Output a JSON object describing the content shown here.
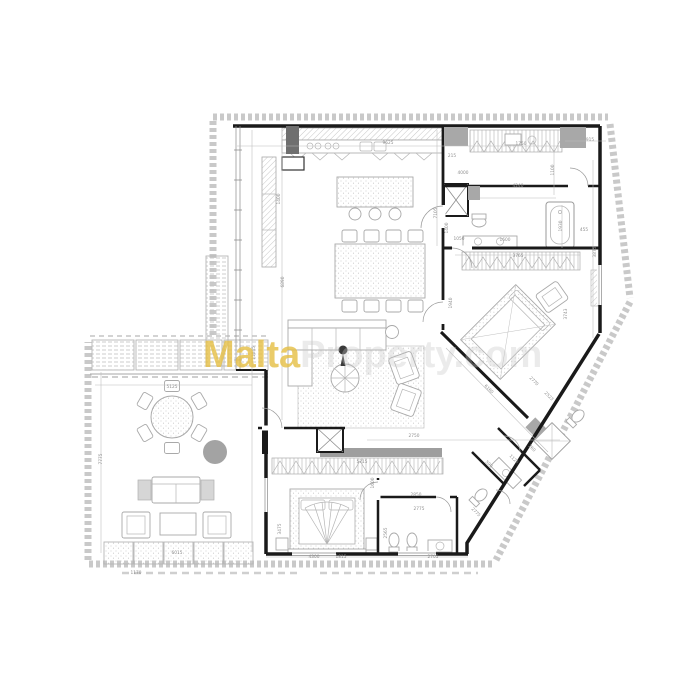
{
  "watermark": {
    "brand_primary": "Malta",
    "brand_secondary": "Property.com",
    "primary_color": "#e5c047",
    "secondary_color": "#c4c4c4"
  },
  "colors": {
    "background": "#ffffff",
    "walls": "#1a1a1a",
    "furniture_lines": "#a9a9a9",
    "hatch": "#c7c7c7",
    "dimension_text": "#8f8f8f",
    "pillar_fill": "#a8a8a8",
    "terrace_plant_fill": "#a3a3a3"
  },
  "dimensions": {
    "d9625": "9625",
    "d215": "215",
    "d1750": "1750",
    "d915": "915",
    "d1100": "1100",
    "d4000": "4000",
    "d4240": "4240",
    "d1400a": "1400",
    "d1930": "1930",
    "d455": "455",
    "d3875": "3875",
    "d1050": "1050",
    "d1600a": "1600",
    "d7105": "7105",
    "d3765": "3765",
    "d3743": "3743",
    "d1940": "1940",
    "d6160": "6160",
    "d2770": "2770",
    "d2523": "2523",
    "d1125": "1125",
    "d260": "260",
    "d590": "590",
    "d2775d": "2775",
    "d5125": "5125",
    "d7775": "7775",
    "d6015": "6015",
    "d1170": "1170",
    "d11045": "11045",
    "d6890": "6890",
    "d1400b": "1400",
    "d2750": "2750",
    "d5715": "5715",
    "d1600b": "1600",
    "d2850": "2850",
    "d2775b": "2775",
    "d2565": "2565",
    "d1815": "1815",
    "d2705": "2705",
    "d4300": "4300",
    "d3475": "3475"
  }
}
